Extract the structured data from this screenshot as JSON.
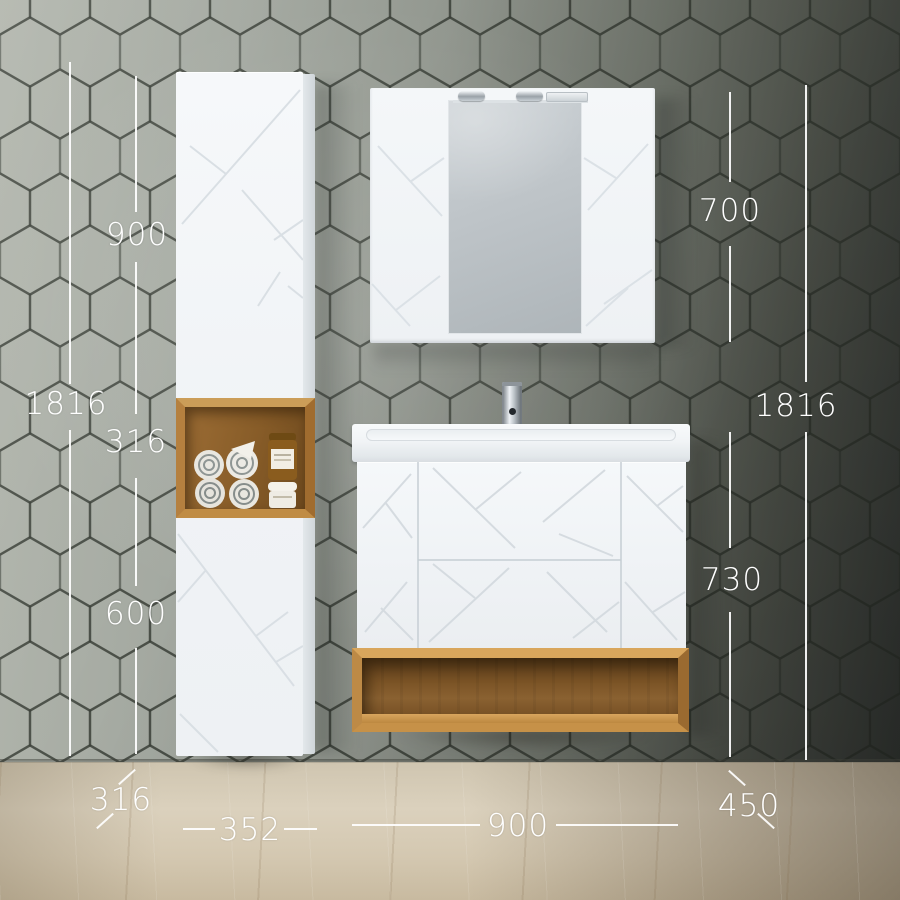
{
  "dims": {
    "left_total_height": "1816",
    "upper_door_height": "900",
    "niche_height": "316",
    "lower_door_height": "600",
    "side_cabinet_depth": "316",
    "side_cabinet_width": "352",
    "mirror_cabinet_height": "700",
    "right_total_height": "1816",
    "vanity_height": "730",
    "vanity_depth": "450",
    "vanity_width": "900"
  },
  "colors": {
    "wall_tile_light": "#a9ada5",
    "wall_tile_dark": "#3b3f3b",
    "furniture_white": "#f3f6f8",
    "oak_wood": "#b5803f",
    "floor_wood": "#d3c7b2",
    "dimension_text": "#ffffff"
  }
}
